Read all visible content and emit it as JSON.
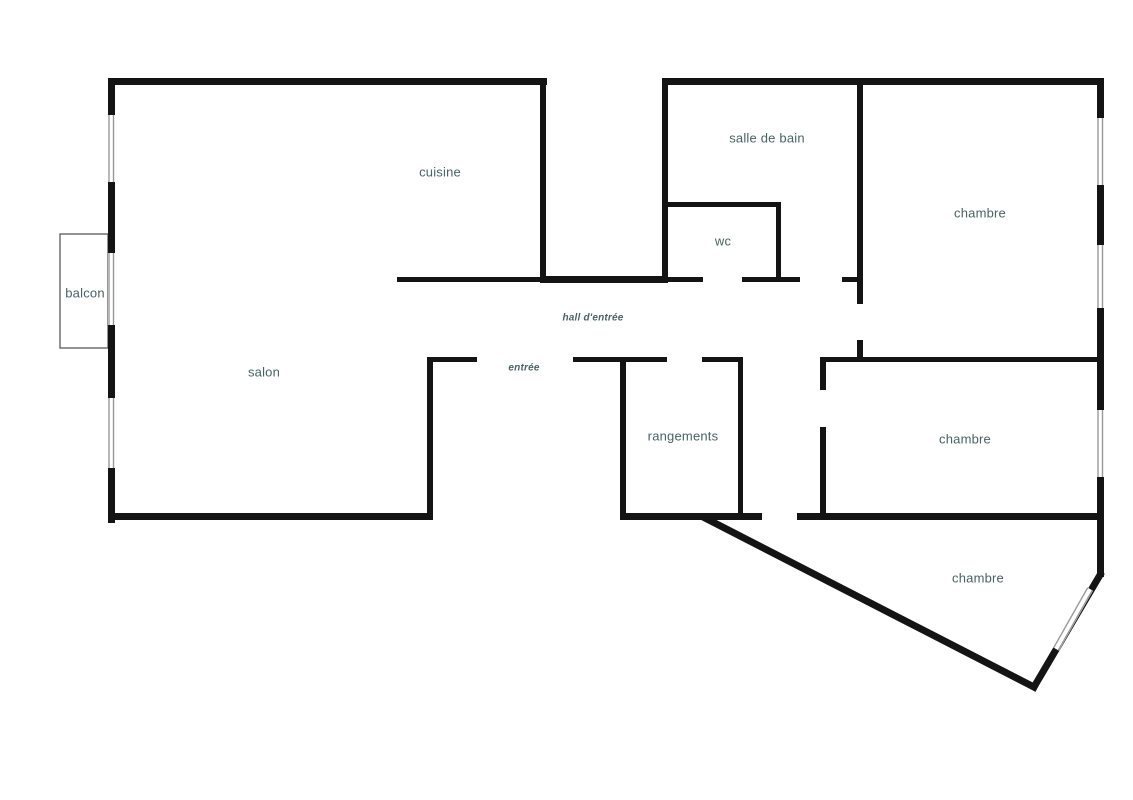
{
  "rooms": {
    "cuisine": {
      "label": "cuisine"
    },
    "salle_de_bain": {
      "label": "salle de bain"
    },
    "chambre_haut": {
      "label": "chambre"
    },
    "wc": {
      "label": "wc"
    },
    "balcon": {
      "label": "balcon"
    },
    "hall_entree": {
      "label": "hall d'entrée"
    },
    "entree": {
      "label": "entrée"
    },
    "salon": {
      "label": "salon"
    },
    "rangements": {
      "label": "rangements"
    },
    "chambre_milieu": {
      "label": "chambre"
    },
    "chambre_bas": {
      "label": "chambre"
    }
  },
  "colors": {
    "wall": "#141414",
    "label": "#4a6262",
    "window_line": "#999999",
    "balcon_outline": "#5a5a5a",
    "background": "#ffffff"
  }
}
